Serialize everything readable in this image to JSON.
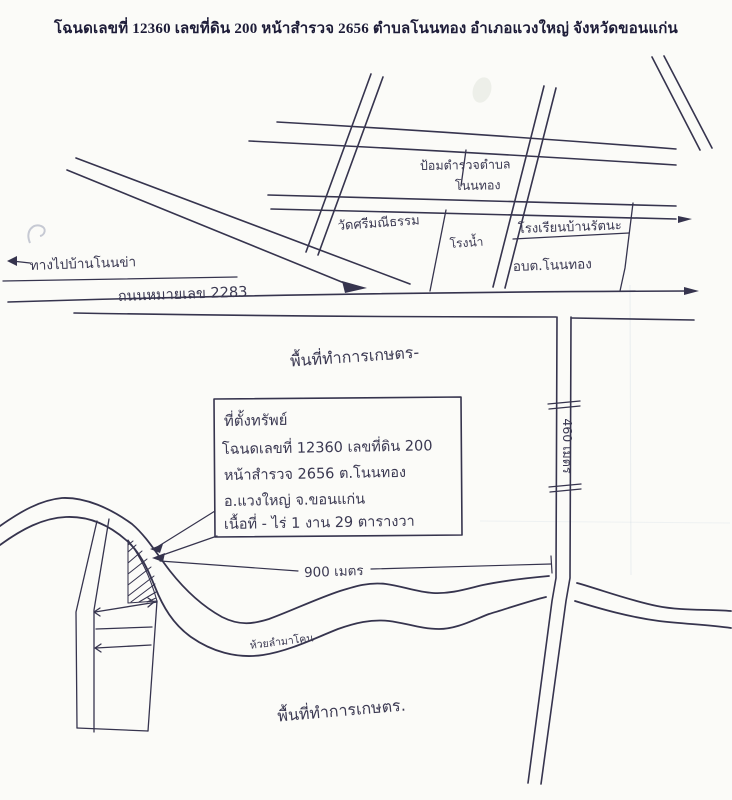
{
  "header": {
    "title": "โฉนดเลขที่ 12360  เลขที่ดิน 200  หน้าสำรวจ 2656  ตำบลโนนทอง  อำเภอแวงใหญ่  จังหวัดขอนแก่น"
  },
  "map": {
    "labels": {
      "way_to_ban_non_kha": "ทางไปบ้านโนนข่า",
      "road_2283": "ถนนหมายเลข 2283",
      "police_box_line1": "ป้อมตำรวจตำบล",
      "police_box_line2": "โนนทอง",
      "temple": "วัดศรีมณีธรรม",
      "water_plant": "โรงน้ำ",
      "school": "โรงเรียนบ้านรัตนะ",
      "sao_nonthong": "อบต.โนนทอง",
      "agri_area_upper": "พื้นที่ทำการเกษตร-",
      "agri_area_lower": "พื้นที่ทำการเกษตร.",
      "stream": "ห้วยลำมาโคน",
      "dist_900m": "900 เมตร",
      "dist_460m": "460 เมตร"
    },
    "info_box": {
      "line1": "ที่ตั้งทรัพย์",
      "line2": "โฉนดเลขที่ 12360  เลขที่ดิน 200",
      "line3": "หน้าสำรวจ 2656  ต.โนนทอง",
      "line4": "อ.แวงใหญ่  จ.ขอนแก่น",
      "line5": "เนื้อที่ - ไร่ 1 งาน 29 ตารางวา"
    },
    "colors": {
      "ink": "#36344e",
      "paper": "#fbfbf8"
    }
  }
}
